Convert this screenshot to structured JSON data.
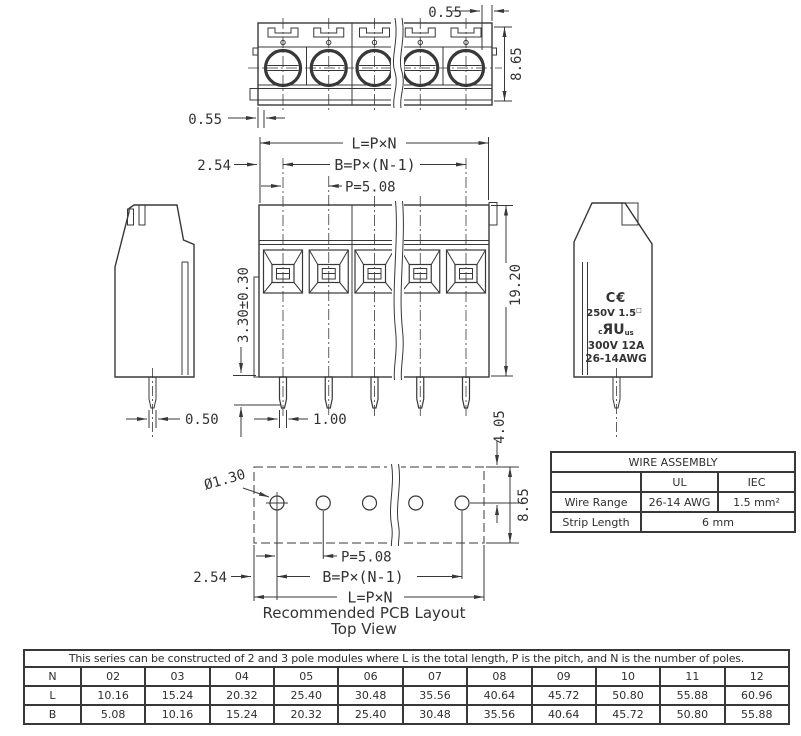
{
  "drawing": {
    "top_view": {
      "dim_gap_top": "0.55",
      "dim_height": "8.65",
      "dim_gap_bottom": "0.55"
    },
    "front_view": {
      "dim_total_length": "L=P×N",
      "dim_spacing": "B=P×(N-1)",
      "dim_pitch": "P=5.08",
      "dim_edge": "2.54",
      "dim_pin_protrusion": "3.30±0.30",
      "dim_body_height": "19.20",
      "dim_pin_thickness": "0.50",
      "dim_pin_width": "1.00"
    },
    "side_marking": {
      "ce": "C€",
      "rating_iec": "250V 1.5",
      "rating_iec_sup": "□",
      "ul_c": "c",
      "ul_mark": "ЯU",
      "ul_us": "us",
      "rating_ul": "300V 12A",
      "wire_awg": "26-14AWG"
    },
    "pcb_layout": {
      "hole_diameter": "Ø1.30",
      "dim_pitch": "P=5.08",
      "dim_spacing": "B=P×(N-1)",
      "dim_total_length": "L=P×N",
      "dim_edge": "2.54",
      "dim_row_offset": "4.05",
      "dim_height": "8.65",
      "caption_line1": "Recommended PCB Layout",
      "caption_line2": "Top View"
    }
  },
  "wire_assembly": {
    "title": "WIRE ASSEMBLY",
    "col_ul": "UL",
    "col_iec": "IEC",
    "wire_range_label": "Wire Range",
    "wire_range_ul": "26-14 AWG",
    "wire_range_iec": "1.5 mm²",
    "strip_length_label": "Strip Length",
    "strip_length_value": "6 mm"
  },
  "dimension_table": {
    "note": "This series can be constructed of 2 and 3 pole modules where L is the total length, P is the pitch, and N is the number of poles.",
    "rows": [
      {
        "label": "N",
        "values": [
          "02",
          "03",
          "04",
          "05",
          "06",
          "07",
          "08",
          "09",
          "10",
          "11",
          "12"
        ]
      },
      {
        "label": "L",
        "values": [
          "10.16",
          "15.24",
          "20.32",
          "25.40",
          "30.48",
          "35.56",
          "40.64",
          "45.72",
          "50.80",
          "55.88",
          "60.96"
        ]
      },
      {
        "label": "B",
        "values": [
          "5.08",
          "10.16",
          "15.24",
          "20.32",
          "25.40",
          "30.48",
          "35.56",
          "40.64",
          "45.72",
          "50.80",
          "55.88"
        ]
      }
    ]
  }
}
